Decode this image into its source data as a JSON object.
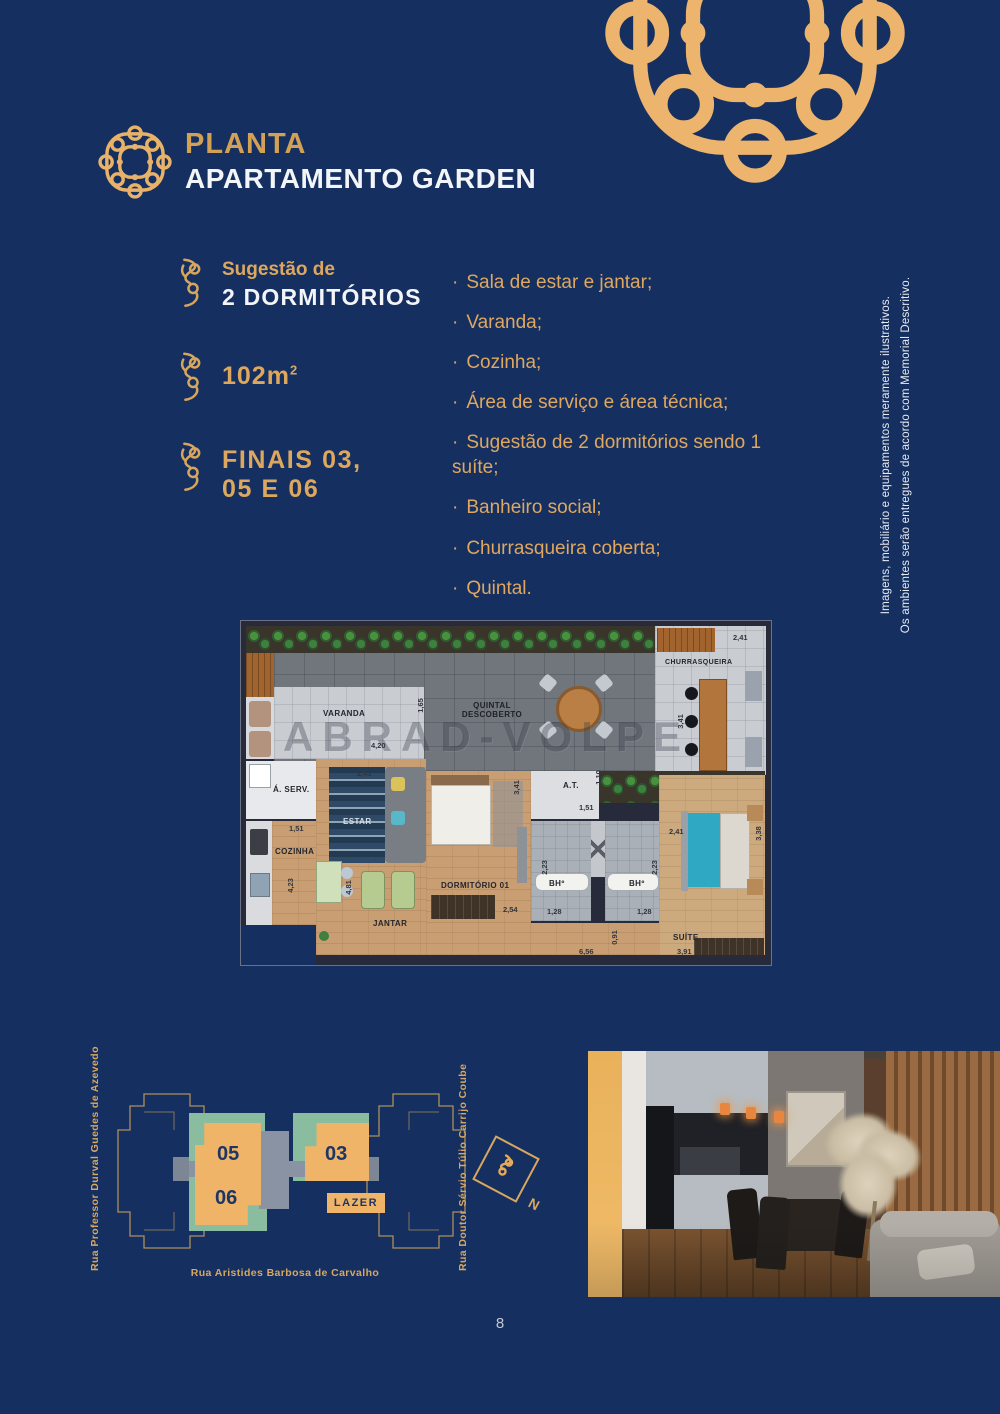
{
  "page": {
    "number": "8",
    "colors": {
      "background": "#153060",
      "accent_gold": "#e9b269",
      "title_gold": "#d3a156",
      "unit_orange": "#efb467",
      "site_green": "#8abda0",
      "site_gray": "#8a93a3"
    }
  },
  "header": {
    "title_accent": "PLANTA",
    "title_main": "APARTAMENTO GARDEN"
  },
  "specs": {
    "item1": {
      "pre": "Sugestão de",
      "main": "2 DORMITÓRIOS"
    },
    "item2": {
      "value": "102m",
      "sup": "2"
    },
    "item3": {
      "line1": "FINAIS 03,",
      "line2": "05 E 06"
    }
  },
  "features": {
    "bullet": "·",
    "items": [
      "Sala de estar e jantar;",
      "Varanda;",
      "Cozinha;",
      "Área de serviço e área técnica;",
      "Sugestão de 2 dormitórios sendo 1 suíte;",
      "Banheiro social;",
      "Churrasqueira coberta;",
      "Quintal."
    ]
  },
  "disclaimer": {
    "line1": "Imagens, mobiliário e equipamentos meramente ilustrativos.",
    "line2": "Os ambientes serão entregues de acordo com Memorial Descritivo."
  },
  "floorplan": {
    "watermark": "ABRAD-VOLPE",
    "rooms": {
      "varanda": {
        "label": "VARANDA",
        "dim_w": "4,20",
        "dim_h": "1,65"
      },
      "quintal": {
        "label": "QUINTAL DESCOBERTO"
      },
      "churrasqueira": {
        "label": "CHURRASQUEIRA",
        "dim_w": "2,41",
        "dim_h": "3,41"
      },
      "area_servico": {
        "label": "Á. SERV."
      },
      "cozinha": {
        "label": "COZINHA",
        "dim_w": "1,51",
        "dim_h": "4,23"
      },
      "estar": {
        "label": "ESTAR",
        "dim_w": "2,41"
      },
      "jantar": {
        "label": "JANTAR",
        "dim_h": "4,81"
      },
      "dormitorio1": {
        "label": "DORMITÓRIO 01",
        "dim_h": "3,41",
        "dim_w": "2,54"
      },
      "area_tecnica": {
        "label": "A.T.",
        "dim_h": "1,10",
        "dim_w": "1,51"
      },
      "banheiro1": {
        "label": "BHº",
        "dim_h": "2,23",
        "dim_w": "1,28"
      },
      "banheiro2": {
        "label": "BHº",
        "dim_h": "2,23",
        "dim_w": "1,28"
      },
      "suite": {
        "label": "SUÍTE",
        "dim_w": "2,41",
        "dim_h": "3,38",
        "dim_w2": "3,91"
      },
      "hall": {
        "dim_w": "6,56",
        "dim_h": "0,91"
      }
    }
  },
  "siteplan": {
    "unit_05": "05",
    "unit_03": "03",
    "unit_06": "06",
    "lazer": "LAZER",
    "street_left": "Rua Professor Durval Guedes de Azevedo",
    "street_right": "Rua Doutor Sérvio Túlio Carrijo Coube",
    "street_bottom": "Rua Aristides Barbosa de Carvalho",
    "compass_north": "N"
  }
}
